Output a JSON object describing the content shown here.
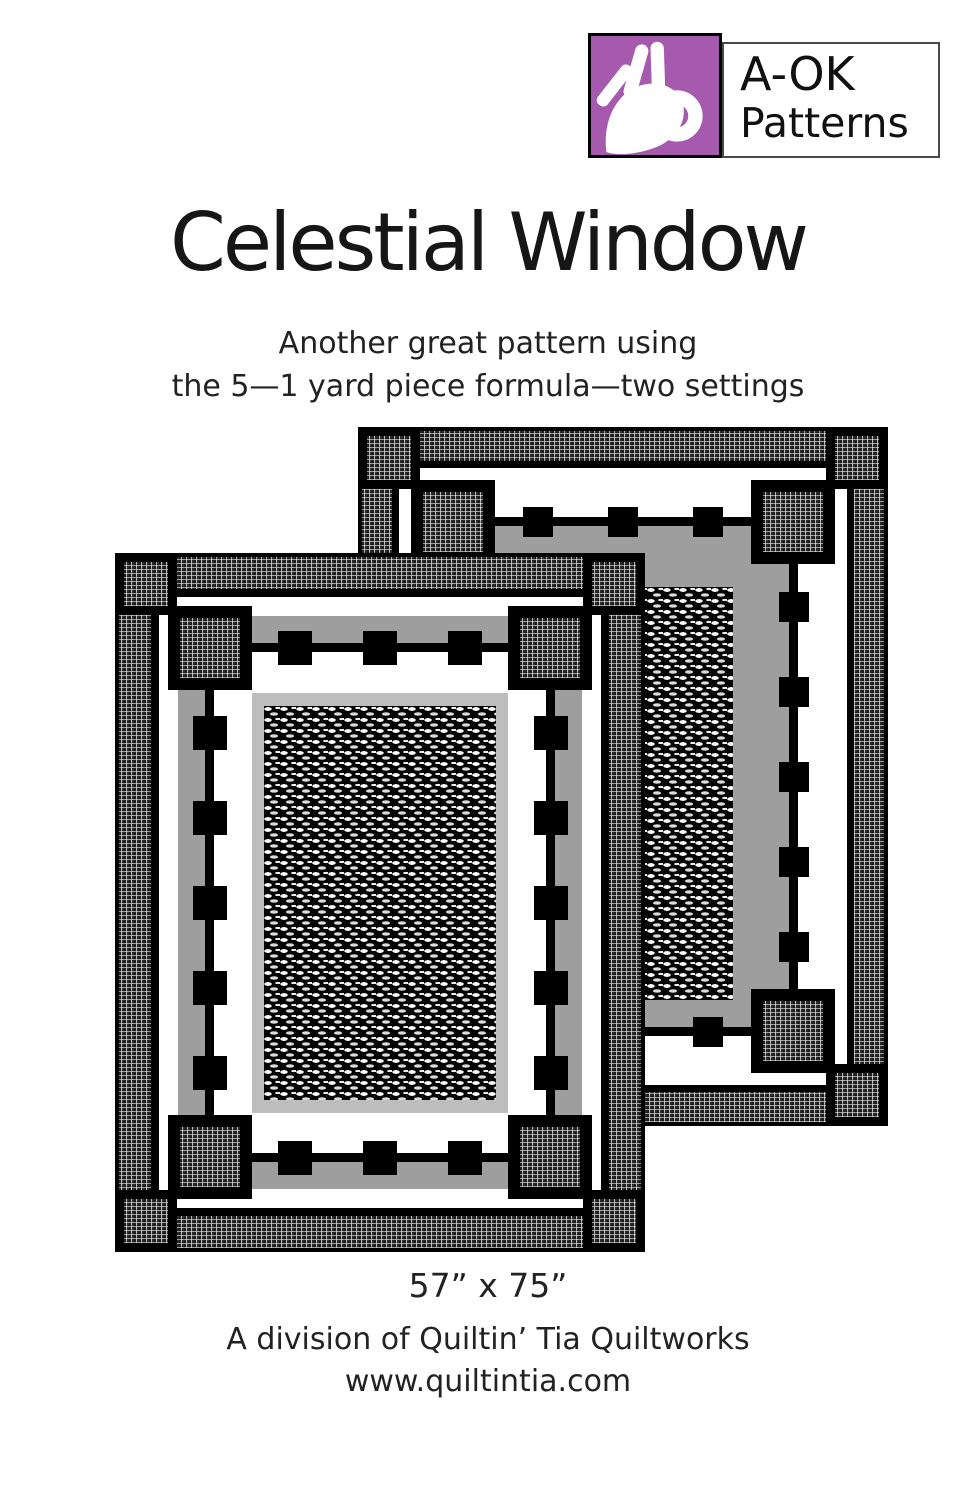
{
  "brand": {
    "line1": "A-OK",
    "line2": "Patterns",
    "icon": "ok-hand-icon"
  },
  "title": "Celestial Window",
  "subtitle": {
    "line1": "Another great pattern using",
    "line2": "the 5—1 yard piece  formula—two settings"
  },
  "footer": {
    "finished_size": "57” x 75”",
    "division": "A division of Quiltin’ Tia Quiltworks",
    "website": "www.quiltintia.com"
  },
  "colors": {
    "logo_purple": "#a55aad",
    "quilt_gray": "#9e9e9e",
    "quilt_silver": "#bdbdbd",
    "fabric_black": "#000000",
    "page_white": "#ffffff"
  }
}
